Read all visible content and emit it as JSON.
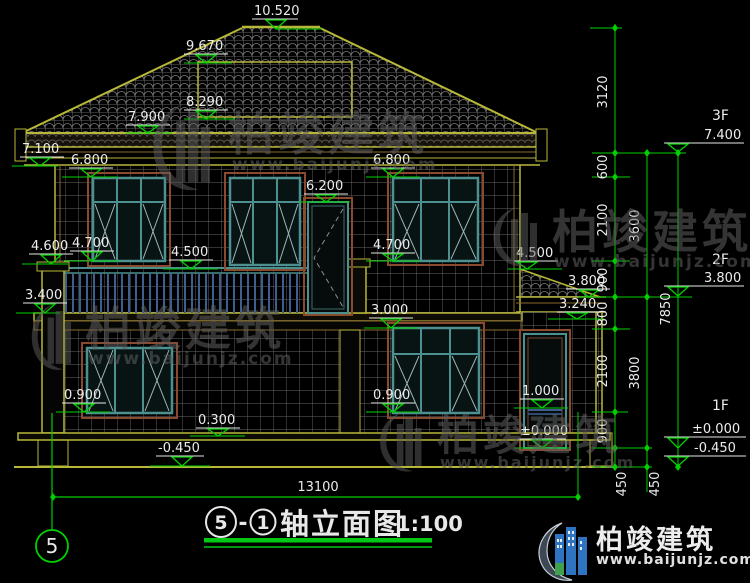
{
  "colors": {
    "background": "#000000",
    "building_line": "#b8b838",
    "dimension_green": "#00d000",
    "text_white": "#e8e8e8",
    "window_frame_teal": "#4d9090",
    "window_surround_brown": "#8a4a2e",
    "railing_blue": "#3d5f8f",
    "watermark_gray": "#5f5f5f",
    "logo_blue": "#2e74c0",
    "logo_green": "#3fa050"
  },
  "levels": {
    "v10520": "10.520",
    "v9670": "9.670",
    "v8290": "8.290",
    "v7900": "7.900",
    "v7100": "7.100",
    "v6800_left": "6.800",
    "v6200": "6.200",
    "v6800_right": "6.800",
    "v4600": "4.600",
    "v4700_left": "4.700",
    "v4500_mid": "4.500",
    "v4700_right": "4.700",
    "v4500_right": "4.500",
    "v3400": "3.400",
    "v3800_porch": "3.800",
    "v3240": "3.240",
    "v3000": "3.000",
    "v0900_left": "0.900",
    "v0900_right": "0.900",
    "v0300": "0.300",
    "v1000": "1.000",
    "v0000_porch": "±0.000",
    "vneg0450": "-0.450"
  },
  "chains": {
    "c3120": "3120",
    "c600": "600",
    "c2100_upper": "2100",
    "c900_upper": "900",
    "c800": "800",
    "c2100_lower": "2100",
    "c900_lower": "900",
    "c450_inner": "450",
    "c3600": "3600",
    "c3800": "3800",
    "c450_mid": "450",
    "c7850": "7850"
  },
  "floors": {
    "f3_label": "3F",
    "f3_value": "7.400",
    "f2_label": "2F",
    "f2_value": "3.800",
    "f1_label": "1F",
    "f1_value": "±0.000",
    "ground_value": "-0.450"
  },
  "bottom": {
    "total_width": "13100"
  },
  "grid_axis": {
    "bubble": "5"
  },
  "title": {
    "axis_left": "5",
    "separator": "-",
    "axis_right": "1",
    "name": "轴立面图",
    "scale": "1:100"
  },
  "watermark": {
    "brand": "柏竣建筑",
    "url": "www.baijunjz.com"
  },
  "logo": {
    "brand": "柏竣建筑",
    "url": "www.baijunjz.com"
  }
}
